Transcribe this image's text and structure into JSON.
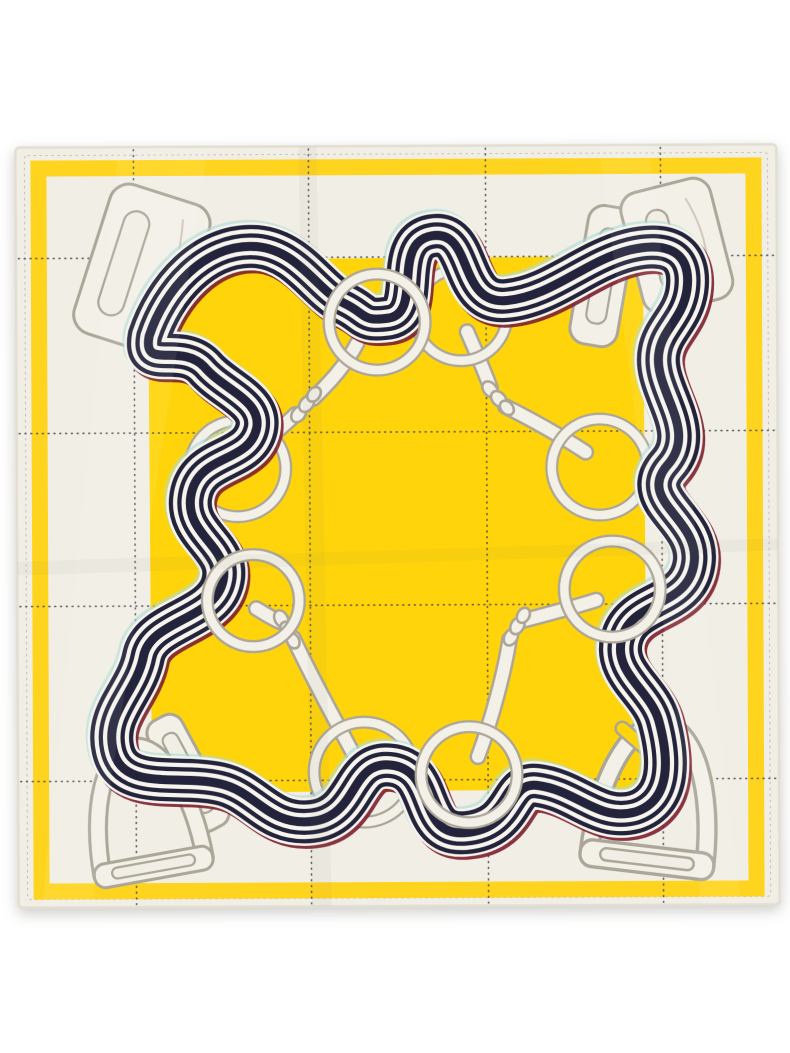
{
  "image": {
    "alt": "Product photograph of a folded square silk scarf on a white background. Ivory field with dashed windowpane grid, bright yellow border band and yellow center square, printed with a winding navy-and-white striped ribbon threaded through white rings, snaffle-bit shanks with chain links, and stirrup buckles at the corners.",
    "subject": "yellow equestrian print silk scarf",
    "background": "white studio backdrop"
  },
  "colors": {
    "background": "#ffffff",
    "scarf-field": "#f1eee6",
    "scarf-hem": "#e2ded2",
    "yellow": "#ffd40a",
    "band-yellow": "#ffd41e",
    "ribbon-dark": "#23233b",
    "ribbon-light": "#f6f4ed",
    "offset-red": "#7c1f2d",
    "offset-cyan": "#aedcd4",
    "hardware-fill": "#f3f0e8",
    "hardware-outline": "#aba698",
    "hardware-shadow": "#cfc9bb",
    "grid-line": "#45454d"
  },
  "scarf": {
    "grid": {
      "vertical_x": [
        135,
        310,
        487,
        662
      ],
      "horizontal_y": [
        257,
        432,
        605,
        780
      ]
    },
    "motifs": {
      "rings": 8,
      "stirrup_buckles": 4,
      "keeper_bars": 2,
      "bit_shanks": 8,
      "chain_junctions": 4,
      "ribbon_stripes_dark": 5
    }
  }
}
